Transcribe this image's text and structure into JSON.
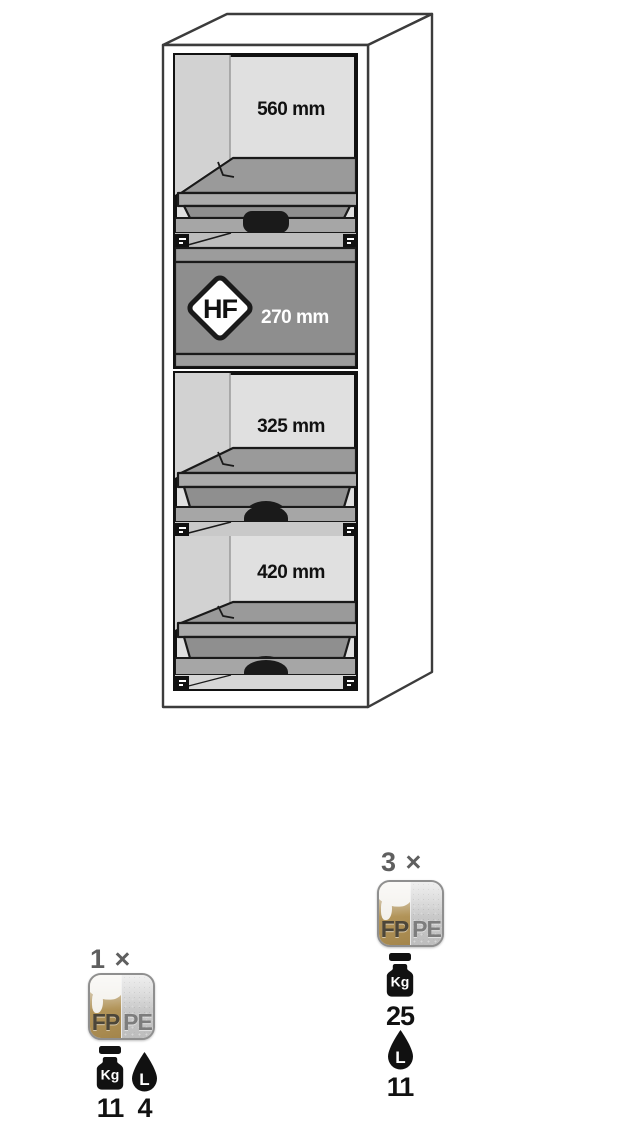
{
  "cabinet": {
    "sections": [
      {
        "name": "top-compartment",
        "dimension": "560 mm"
      },
      {
        "name": "hf-drawer-box",
        "dimension": "270 mm",
        "hazard_code": "HF"
      },
      {
        "name": "middle-compartment",
        "dimension": "325 mm"
      },
      {
        "name": "bottom-compartment",
        "dimension": "420 mm"
      }
    ]
  },
  "annotations": {
    "left": {
      "count": "1 ×",
      "material_left": "FP",
      "material_right": "PE",
      "weight_unit": "Kg",
      "weight_value": "11",
      "volume_unit": "L",
      "volume_value": "4"
    },
    "right": {
      "count": "3 ×",
      "material_left": "FP",
      "material_right": "PE",
      "weight_unit": "Kg",
      "weight_value": "25",
      "volume_unit": "L",
      "volume_value": "11"
    }
  },
  "icons": {
    "fp_pe_swatch": "two-tone material swatch (gold FP / grey PE)",
    "weight_icon": "black kettlebell weight silhouette",
    "drop_icon": "black liquid drop silhouette",
    "hf_diamond": "white diamond hazard plate"
  },
  "colors": {
    "interior_grey": "#e0e0e0",
    "wall_grey": "#d2d2d2",
    "tray_grey": "#9a9a9a",
    "box_grey": "#8e8e8e",
    "gold": "#b29459",
    "outline_black": "#1a1a1a",
    "count_grey": "#5f5f5f"
  }
}
